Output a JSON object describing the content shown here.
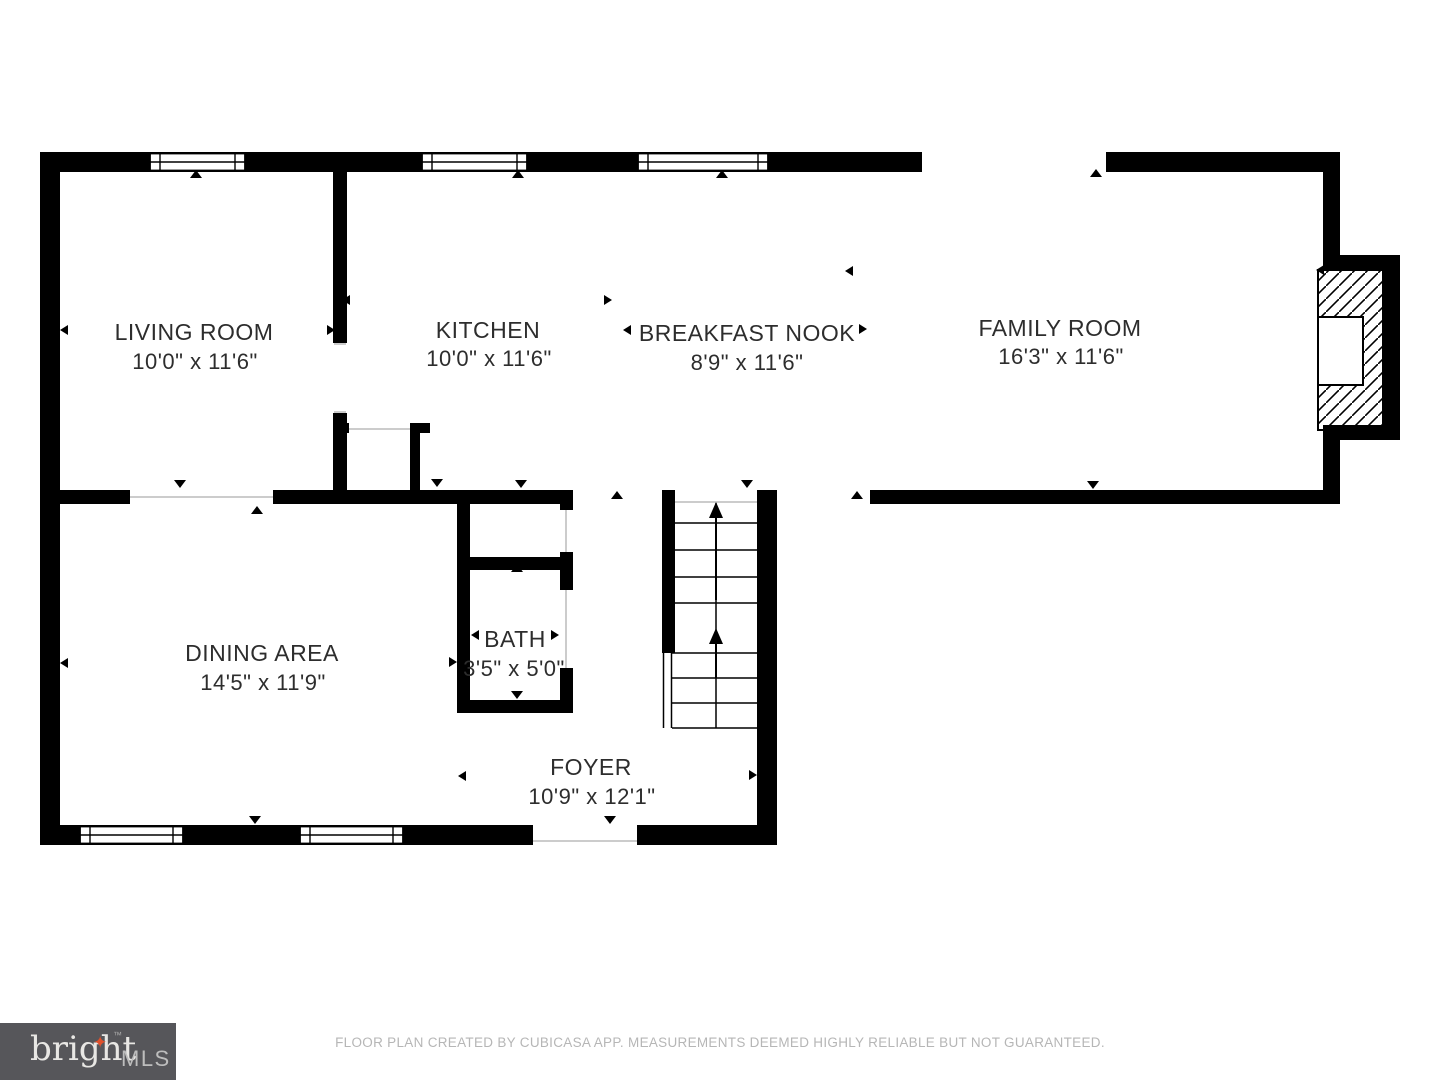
{
  "rooms": [
    {
      "id": "living-room",
      "name": "LIVING ROOM",
      "dims": "10'0\" x 11'6\""
    },
    {
      "id": "kitchen",
      "name": "KITCHEN",
      "dims": "10'0\" x 11'6\""
    },
    {
      "id": "breakfast-nook",
      "name": "BREAKFAST NOOK",
      "dims": "8'9\" x 11'6\""
    },
    {
      "id": "family-room",
      "name": "FAMILY ROOM",
      "dims": "16'3\" x 11'6\""
    },
    {
      "id": "dining-area",
      "name": "DINING AREA",
      "dims": "14'5\" x 11'9\""
    },
    {
      "id": "bath",
      "name": "BATH",
      "dims": "3'5\" x 5'0\""
    },
    {
      "id": "foyer",
      "name": "FOYER",
      "dims": "10'9\" x 12'1\""
    }
  ],
  "branding": {
    "logo_text": "bright",
    "logo_trademark": "™",
    "logo_star_glyph": "✦",
    "logo_suffix": "MLS",
    "logo_bg_color": "#56565a",
    "logo_star_color": "#e0512c"
  },
  "footer": {
    "disclaimer": "FLOOR PLAN CREATED BY CUBICASA APP. MEASUREMENTS DEEMED HIGHLY RELIABLE BUT NOT GUARANTEED."
  },
  "colors": {
    "wall": "#000000",
    "room_label": "#2d2d2d",
    "opening_line": "#cccccc",
    "footer_text": "#b6b6b6"
  }
}
